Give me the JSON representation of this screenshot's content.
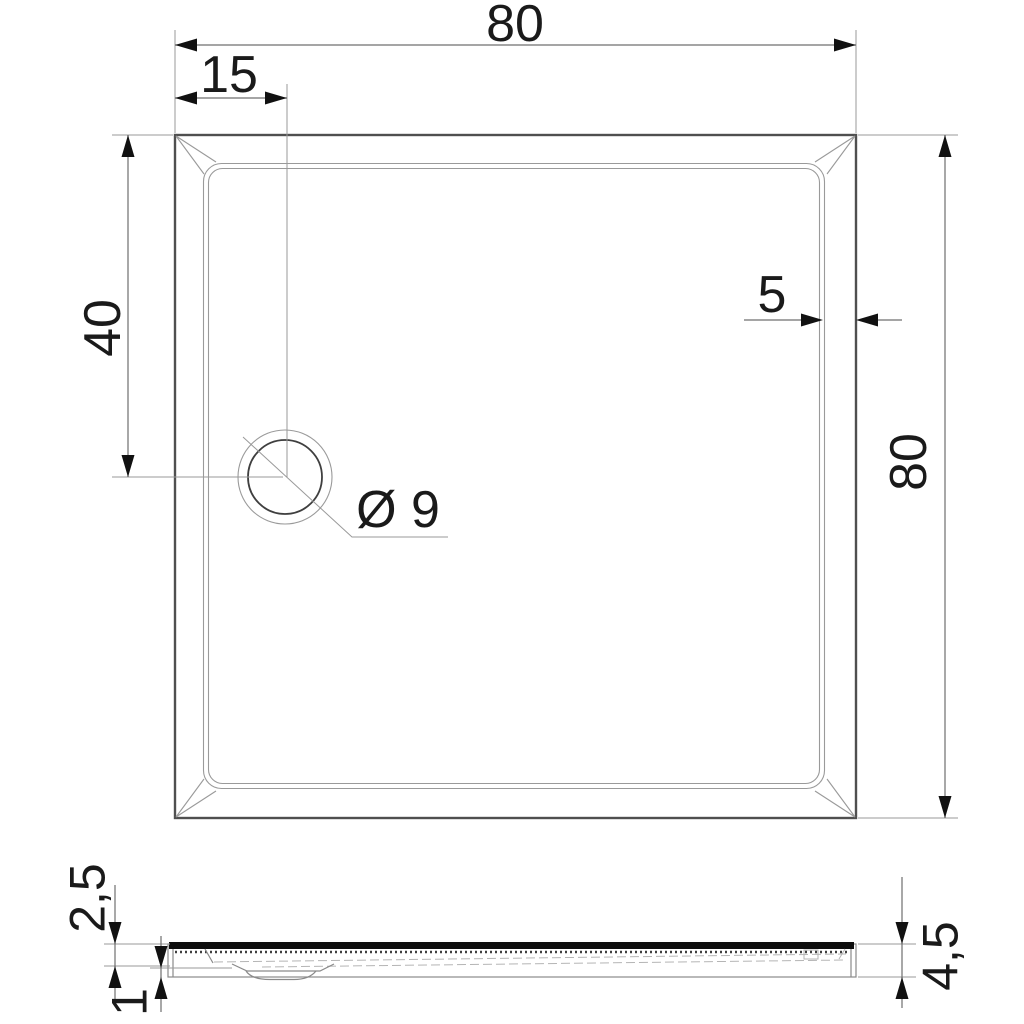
{
  "drawing": {
    "type": "shower-tray-technical-drawing",
    "colors": {
      "background": "#ffffff",
      "outline_strong": "#4f4f4f",
      "outline_thin": "#9a9a9a",
      "dimension_line": "#6f6f6f",
      "text": "#1a1a1a",
      "profile_surface": "#0d0d0d"
    },
    "top_view": {
      "dim_width_label": "80",
      "dim_drain_offset_x_label": "15",
      "dim_drain_offset_y_label": "40",
      "dim_rim_width_label": "5",
      "dim_depth_label": "80",
      "drain_diameter_label": "Ø 9"
    },
    "side_view": {
      "dim_rim_height_label": "2,5",
      "dim_foot_height_label": "1",
      "dim_total_height_label": "4,5"
    }
  }
}
